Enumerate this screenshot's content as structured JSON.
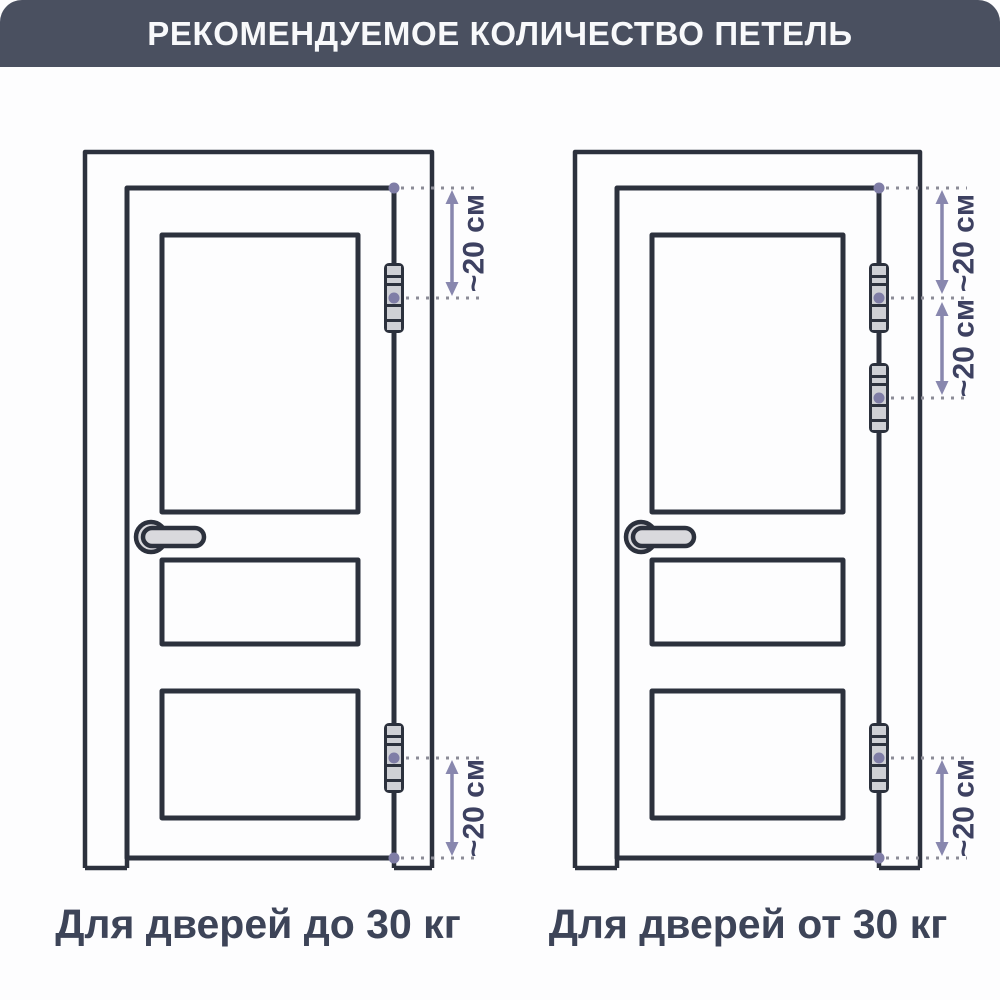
{
  "header": {
    "title": "РЕКОМЕНДУЕМОЕ КОЛИЧЕСТВО ПЕТЕЛЬ"
  },
  "figures": [
    {
      "caption": "Для дверей до 30 кг",
      "hinge_count": 2,
      "dimensions": [
        {
          "label": "~20 см"
        },
        {
          "label": "~20 см"
        }
      ]
    },
    {
      "caption": "Для дверей от 30 кг",
      "hinge_count": 3,
      "dimensions": [
        {
          "label": "~20 см"
        },
        {
          "label": "~20 см"
        },
        {
          "label": "~20 см"
        }
      ]
    }
  ],
  "colors": {
    "header_bg": "#4a5060",
    "line_dark": "#2c313d",
    "accent_arrow": "#8887ae",
    "marker_dot": "#7f7da6",
    "dotted_line": "#8c8c97",
    "dimension_text": "#3d4161",
    "caption_text": "#3d4458",
    "hinge_fill": "#cfd0d5",
    "handle_fill": "#d9d9dd",
    "background": "#fdfdfe"
  }
}
